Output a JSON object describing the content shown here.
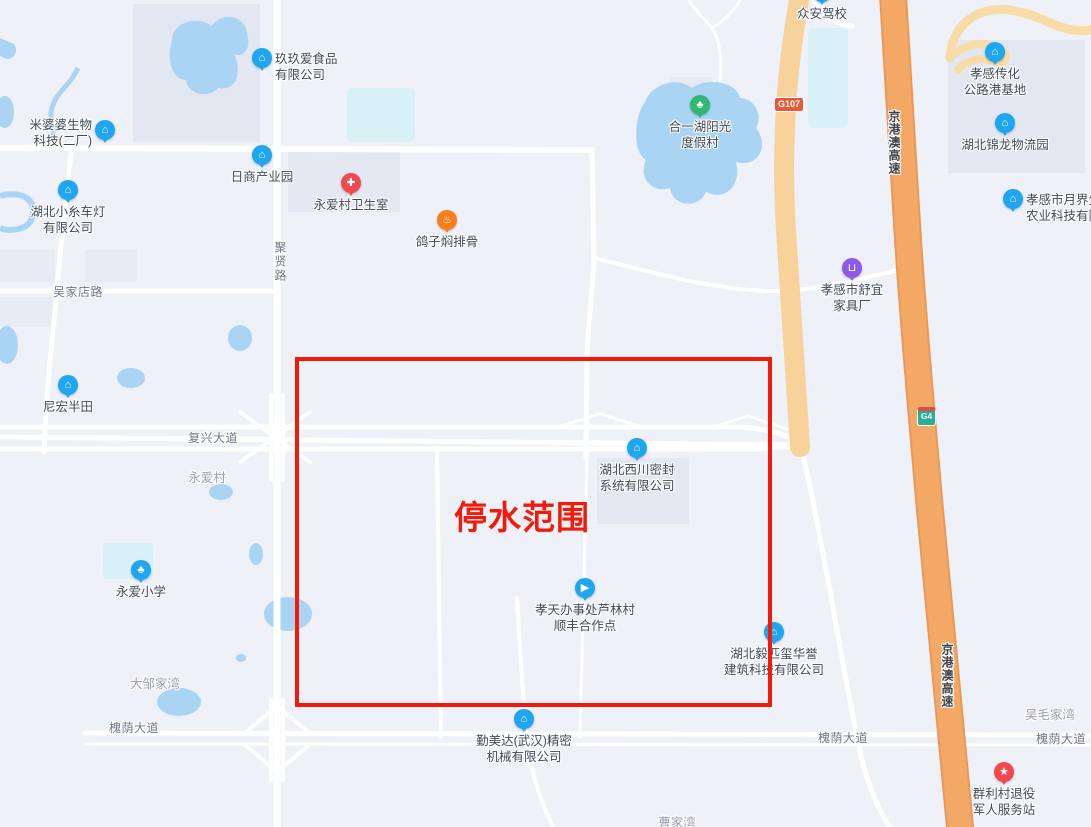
{
  "overlay": {
    "label": "停水范围",
    "color": "#F31A0A",
    "rect": {
      "x": 295,
      "y": 357,
      "w": 469,
      "h": 342
    }
  },
  "badges": [
    {
      "text": "G107"
    },
    {
      "text": "G4"
    }
  ],
  "road_labels": [
    {
      "text": "吴家店路"
    },
    {
      "text": "复兴大道"
    },
    {
      "text": "槐荫大道"
    },
    {
      "text": "槐荫大道"
    },
    {
      "text": "槐荫大道"
    },
    {
      "text": "聚贤路"
    },
    {
      "text": "京港澳高速"
    },
    {
      "text": "京港澳高速"
    }
  ],
  "area_labels": [
    {
      "text": "永爱村"
    },
    {
      "text": "大邹家湾"
    },
    {
      "text": "曹家湾"
    },
    {
      "text": "吴毛家湾"
    }
  ],
  "pois": [
    {
      "icon": "building-icon",
      "lines": [
        "玖玖爱食品",
        "有限公司"
      ]
    },
    {
      "icon": "building-icon",
      "lines": [
        "米婆婆生物",
        "科技(二厂)"
      ]
    },
    {
      "icon": "building-icon",
      "lines": [
        "日商产业园"
      ]
    },
    {
      "icon": "building-icon",
      "lines": [
        "湖北小糸车灯",
        "有限公司"
      ]
    },
    {
      "icon": "building-icon",
      "lines": [
        "尼宏半田"
      ]
    },
    {
      "icon": "tree-icon",
      "lines": [
        "永爱小学"
      ]
    },
    {
      "icon": "building-icon",
      "lines": [
        "湖北西川密封",
        "系统有限公司"
      ]
    },
    {
      "icon": "truck-icon",
      "lines": [
        "孝天办事处芦林村",
        "顺丰合作点"
      ]
    },
    {
      "icon": "building-icon",
      "lines": [
        "湖北毅匹玺华誉",
        "建筑科技有限公司"
      ]
    },
    {
      "icon": "building-icon",
      "lines": [
        "勤美达(武汉)精密",
        "机械有限公司"
      ]
    },
    {
      "icon": "building-icon",
      "lines": [
        "孝感传化",
        "公路港基地"
      ]
    },
    {
      "icon": "building-icon",
      "lines": [
        "湖北锦龙物流园"
      ]
    },
    {
      "icon": "building-icon",
      "lines": [
        "孝感市月界生",
        "农业科技有限"
      ]
    },
    {
      "icon": "bag-icon",
      "lines": [
        "孝感市舒宜",
        "家具厂"
      ]
    },
    {
      "icon": "flag-icon",
      "lines": [
        "众安驾校"
      ]
    },
    {
      "icon": "cross-icon",
      "lines": [
        "永爱村卫生室"
      ]
    },
    {
      "icon": "food-icon",
      "lines": [
        "鸽子焖排骨"
      ]
    },
    {
      "icon": "star-icon",
      "lines": [
        "群利村退役",
        "军人服务站"
      ]
    },
    {
      "icon": "tree-icon",
      "lines": [
        "合一湖阳光",
        "度假村"
      ]
    }
  ]
}
